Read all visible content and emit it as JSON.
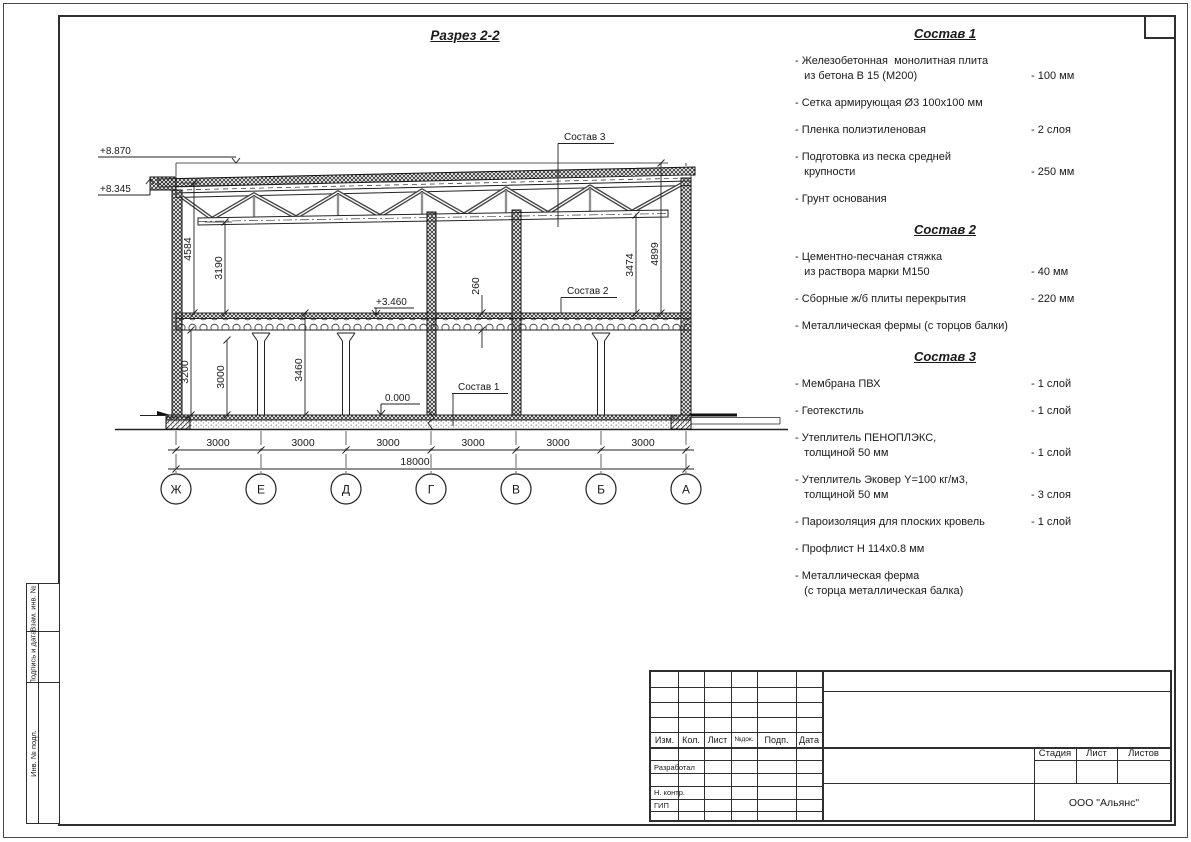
{
  "drawing": {
    "title": "Разрез 2-2",
    "elev_high": "+8.870",
    "elev_roof": "+8.345",
    "elev_floor2": "+3.460",
    "elev_zero": "0.000",
    "dim_left_outer": "4584",
    "dim_left_inner": "3190",
    "dim_gf1": "3200",
    "dim_gf2": "3000",
    "dim_gf3": "3460",
    "dim_slab": "260",
    "dim_right_inner": "3474",
    "dim_right_outer": "4899",
    "dim_bay": "3000",
    "dim_total": "18000",
    "axes": [
      "Ж",
      "Е",
      "Д",
      "Г",
      "В",
      "Б",
      "А"
    ],
    "callout1": "Состав 1",
    "callout2": "Состав 2",
    "callout3": "Состав 3"
  },
  "specs": [
    {
      "title": "Состав 1",
      "items": [
        {
          "name": "- Железобетонная  монолитная плита\n   из бетона В 15 (М200)",
          "value": "- 100 мм"
        },
        {
          "name": "- Сетка армирующая Ø3 100х100 мм",
          "value": ""
        },
        {
          "name": "- Пленка полиэтиленовая",
          "value": "-  2 слоя"
        },
        {
          "name": "- Подготовка из песка средней\n   крупности",
          "value": "- 250 мм"
        },
        {
          "name": "- Грунт основания",
          "value": ""
        }
      ]
    },
    {
      "title": "Состав 2",
      "items": [
        {
          "name": "- Цементно-песчаная стяжка\n   из раствора марки М150",
          "value": "- 40 мм"
        },
        {
          "name": "- Сборные ж/б плиты перекрытия",
          "value": "- 220 мм"
        },
        {
          "name": "- Металлическая фермы (с торцов балки)",
          "value": ""
        }
      ]
    },
    {
      "title": "Состав 3",
      "items": [
        {
          "name": "- Мембрана ПВХ",
          "value": "- 1 слой"
        },
        {
          "name": "- Геотекстиль",
          "value": "- 1 слой"
        },
        {
          "name": "- Утеплитель ПЕНОПЛЭКС,\n   толщиной 50 мм",
          "value": "- 1 слой"
        },
        {
          "name": "- Утеплитель Эковер Y=100 кг/м3,\n   толщиной 50 мм",
          "value": "- 3 слоя"
        },
        {
          "name": "- Пароизоляция для плоских кровель",
          "value": "- 1 слой"
        },
        {
          "name": "- Профлист Н 114х0.8 мм",
          "value": ""
        },
        {
          "name": "- Металлическая ферма\n   (с торца металлическая балка)",
          "value": ""
        }
      ]
    }
  ],
  "title_block": {
    "header": [
      "Изм.",
      "Кол.",
      "Лист",
      "№док.",
      "Подп.",
      "Дата"
    ],
    "row_developed": "Разработал",
    "row_ncontr": "Н. контр.",
    "row_gip": "ГИП",
    "stage": [
      "Стадия",
      "Лист",
      "Листов"
    ],
    "company": "ООО \"Альянс\""
  },
  "sidebar": {
    "labels": [
      "Взам. инв. №",
      "Подпись и дата",
      "Инв. № подл."
    ]
  }
}
